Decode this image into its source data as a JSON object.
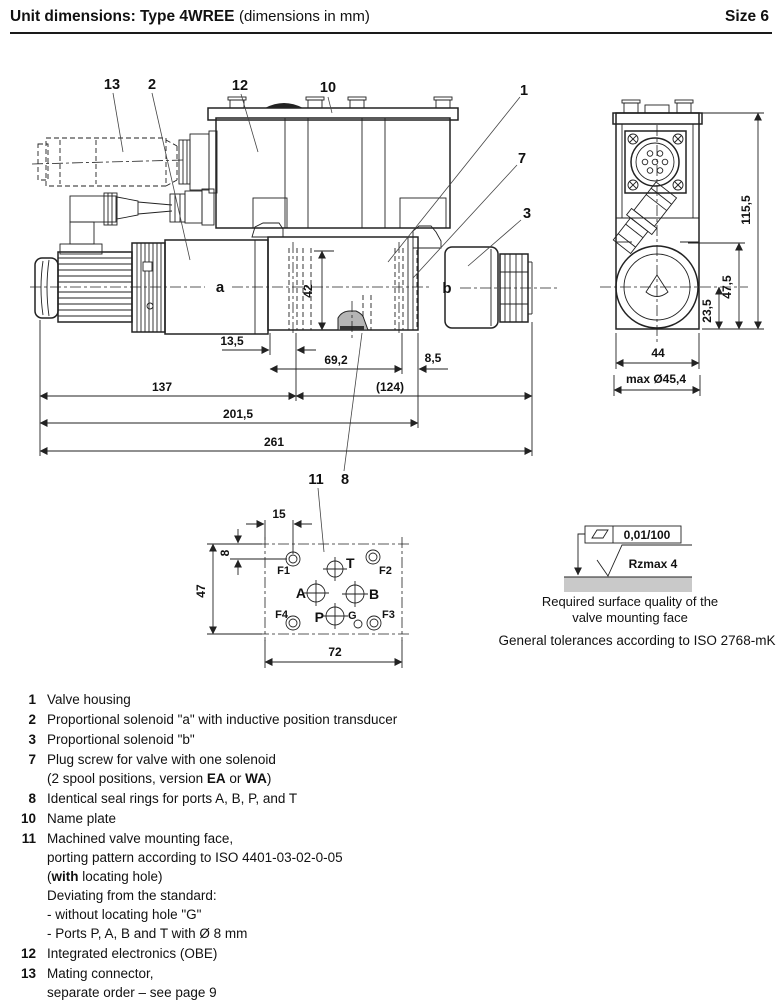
{
  "header": {
    "title_bold": "Unit dimensions: Type 4WREE",
    "title_norm": "(dimensions in mm)",
    "size": "Size 6"
  },
  "main_view": {
    "callouts": {
      "c13": "13",
      "c2": "2",
      "c12": "12",
      "c10": "10",
      "c1": "1",
      "c7": "7",
      "c3": "3",
      "c11": "11",
      "c8": "8"
    },
    "solenoid_a": "a",
    "solenoid_b": "b",
    "dims": {
      "d42": "42",
      "d13_5": "13,5",
      "d69_2": "69,2",
      "d8_5": "8,5",
      "d137": "137",
      "d124": "(124)",
      "d201_5": "201,5",
      "d261": "261"
    }
  },
  "side_view": {
    "dims": {
      "d115_5": "115,5",
      "d47_5": "47,5",
      "d23_5": "23,5",
      "d44": "44",
      "dmax": "max Ø45,4"
    }
  },
  "mounting_face": {
    "dims": {
      "d15": "15",
      "d8": "8",
      "d47": "47",
      "d72": "72"
    },
    "ports": {
      "T": "T",
      "A": "A",
      "B": "B",
      "P": "P",
      "G": "G",
      "F1": "F1",
      "F2": "F2",
      "F3": "F3",
      "F4": "F4"
    }
  },
  "surface_note": {
    "flatness": "0,01/100",
    "roughness": "Rzmax  4",
    "caption_line1": "Required surface quality of the",
    "caption_line2": "valve mounting face",
    "tolerance_note": "General tolerances according to ISO 2768-mK"
  },
  "colors": {
    "line": "#222222",
    "seal_fill": "#b5b5b5",
    "surface_fill": "#c9c9c9"
  },
  "legend": {
    "items": [
      {
        "num": "1",
        "lines": [
          "Valve housing"
        ]
      },
      {
        "num": "2",
        "lines": [
          "Proportional solenoid \"a\" with inductive position transducer"
        ]
      },
      {
        "num": "3",
        "lines": [
          "Proportional solenoid \"b\""
        ]
      },
      {
        "num": "7",
        "lines": [
          "Plug screw for valve with one solenoid",
          "(2 spool positions, version **EA** or **WA**)"
        ]
      },
      {
        "num": "8",
        "lines": [
          "Identical seal rings for ports A, B, P, and T"
        ]
      },
      {
        "num": "10",
        "lines": [
          "Name plate"
        ]
      },
      {
        "num": "11",
        "lines": [
          "Machined valve mounting face,",
          "porting pattern according to ISO 4401-03-02-0-05",
          "(**with** locating hole)",
          "Deviating from the standard:",
          "- without locating hole \"G\"",
          "- Ports P, A, B and T with Ø 8 mm"
        ]
      },
      {
        "num": "12",
        "lines": [
          "Integrated electronics (OBE)"
        ]
      },
      {
        "num": "13",
        "lines": [
          "Mating connector,",
          "separate order – see page 9"
        ]
      }
    ]
  }
}
